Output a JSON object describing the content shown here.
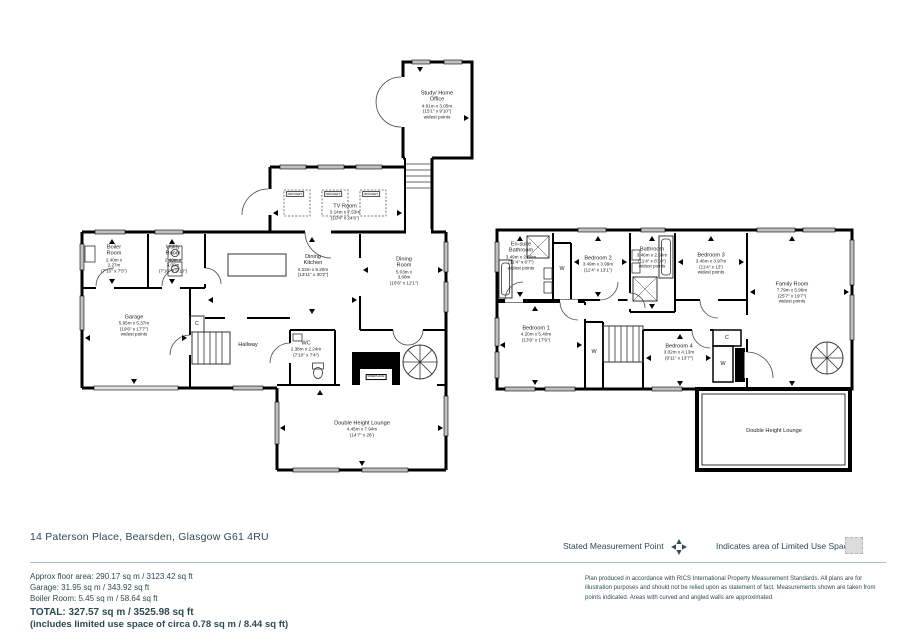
{
  "page": {
    "background": "#ffffff",
    "ink": "#000000",
    "text_color": "#2e4a52",
    "window_color": "#c0c0c0"
  },
  "footer": {
    "address": "14 Paterson Place, Bearsden, Glasgow G61 4RU",
    "areas": {
      "approx": "Approx floor area: 290.17 sq m / 3123.42 sq ft",
      "garage": "Garage: 31.95 sq m / 343.92 sq ft",
      "boiler": "Boiler Room: 5.45 sq m / 58.64 sq ft",
      "total": "TOTAL: 327.57 sq m / 3525.98 sq ft",
      "limited": "(includes limited use space of circa 0.78 sq m / 8.44 sq ft)"
    },
    "legend": {
      "measurement_label": "Stated Measurement Point",
      "limited_label": "Indicates area of  Limited Use Space"
    },
    "disclaimer": "Plan produced in accordance with RICS International Property Measurement Standards.  All plans are for illustration purposes and should not be relied upon as statement of fact.  Measurements shown are taken from points indicated.  Areas with curved and angled walls are approximated."
  },
  "ground_floor": {
    "rooms": {
      "study": {
        "name": "Study/ Home Office",
        "dims": "4.81m x 3.05m",
        "dims_ft": "(15'1\" x 9'10\")",
        "note": "widest points"
      },
      "tv": {
        "name": "TV Room",
        "dims": "3.14m x 7.53m",
        "dims_ft": "(10'4\" x 24'8\")"
      },
      "boiler": {
        "name": "Boiler Room",
        "dims": "2.40m x 2.27m",
        "dims_ft": "(7'10\" x 7'5\")"
      },
      "utility": {
        "name": "Utility Room",
        "dims": "2.40m x 3.00m",
        "dims_ft": "(7'10\" x 9'10\")"
      },
      "kitchen": {
        "name": "Dining Kitchen",
        "dims": "4.23m x 9.20m",
        "dims_ft": "(13'11\" x 30'2\")"
      },
      "dining": {
        "name": "Dining Room",
        "dims": "5.03m x 3.68m",
        "dims_ft": "(16'6\" x 12'1\")"
      },
      "garage": {
        "name": "Garage",
        "dims": "5.95m x 5.37m",
        "dims_ft": "(19'6\" x 17'7\")",
        "note": "widest points"
      },
      "hallway": {
        "name": "Hallway"
      },
      "wc": {
        "name": "WC",
        "dims": "2.38m x 2.24m",
        "dims_ft": "(7'10\" x 7'4\")"
      },
      "lounge": {
        "name": "Double Height Lounge",
        "dims": "4.45m x 7.94m",
        "dims_ft": "(14'7\" x 26')"
      }
    },
    "markers": {
      "cupboard": "C",
      "fireplace": "FIREPLACE",
      "skylight": "SKYLIGHT"
    }
  },
  "first_floor": {
    "rooms": {
      "ensuite": {
        "name": "En-suite Bathroom",
        "dims": "3.49m x 2.00m",
        "dims_ft": "(11'4\" x 6'7\")",
        "note": "widest points"
      },
      "bedroom2": {
        "name": "Bedroom 2",
        "dims": "3.49m x 3.99m",
        "dims_ft": "(11'4\" x 13'1\")"
      },
      "bathroom": {
        "name": "Bathroom",
        "dims": "3.46m x 2.69m",
        "dims_ft": "(11'4\" x 8'10\")",
        "note": "widest points"
      },
      "bedroom3": {
        "name": "Bedroom 3",
        "dims": "3.46m x 3.97m",
        "dims_ft": "(11'4\" x 13')",
        "note": "widest points"
      },
      "family": {
        "name": "Family Room",
        "dims": "7.79m x 5.96m",
        "dims_ft": "(25'7\" x 19'7\")",
        "note": "widest points"
      },
      "bedroom1": {
        "name": "Bedroom 1",
        "dims": "4.20m x 5.40m",
        "dims_ft": "(13'9\" x 17'9\")"
      },
      "bedroom4": {
        "name": "Bedroom 4",
        "dims": "3.02m x 4.13m",
        "dims_ft": "(9'11\" x 13'7\")"
      },
      "void": {
        "name": "Double Height Lounge"
      }
    },
    "markers": {
      "wardrobe": "W",
      "cupboard": "C"
    }
  }
}
